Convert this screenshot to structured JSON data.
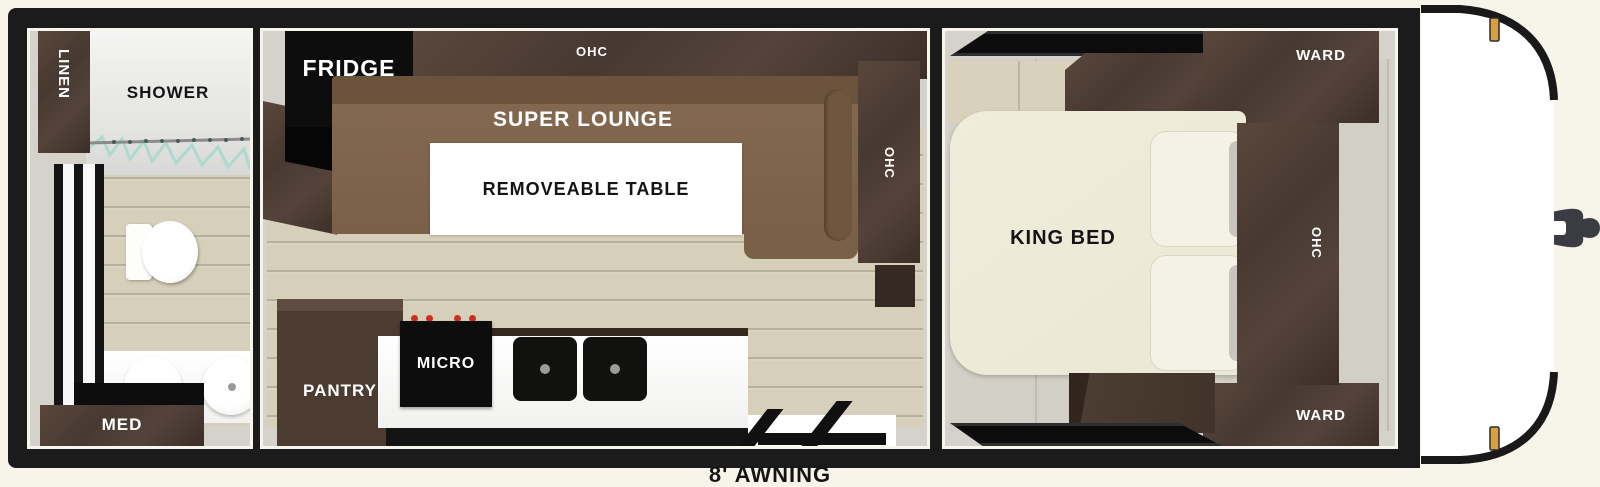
{
  "floorplan": {
    "awning_label": "8' AWNING",
    "bathroom": {
      "linen": "LINEN",
      "shower": "SHOWER",
      "med": "MED"
    },
    "kitchen": {
      "fridge": "FRIDGE",
      "ohc_top": "OHC",
      "lounge": "SUPER LOUNGE",
      "table": "REMOVEABLE TABLE",
      "ohc_right": "OHC",
      "pantry": "PANTRY",
      "micro": "MICRO"
    },
    "bedroom": {
      "ward_top": "WARD",
      "ohc": "OHC",
      "bed": "KING BED",
      "ward_bottom": "WARD"
    }
  },
  "colors": {
    "wall_black": "#1b1b1b",
    "dark_wood": "#4a3a31",
    "lounge_brown": "#7d6349",
    "bed_cream": "#efebd9",
    "floor_tan": "#d6d0bb",
    "wall_gray": "#d3d1ca",
    "marker_light_amber": "#dd9f3e",
    "cap_white": "#ffffff",
    "shower_glass_teal": "#a8d8cf",
    "stove_knob_red": "#cc2f22"
  }
}
